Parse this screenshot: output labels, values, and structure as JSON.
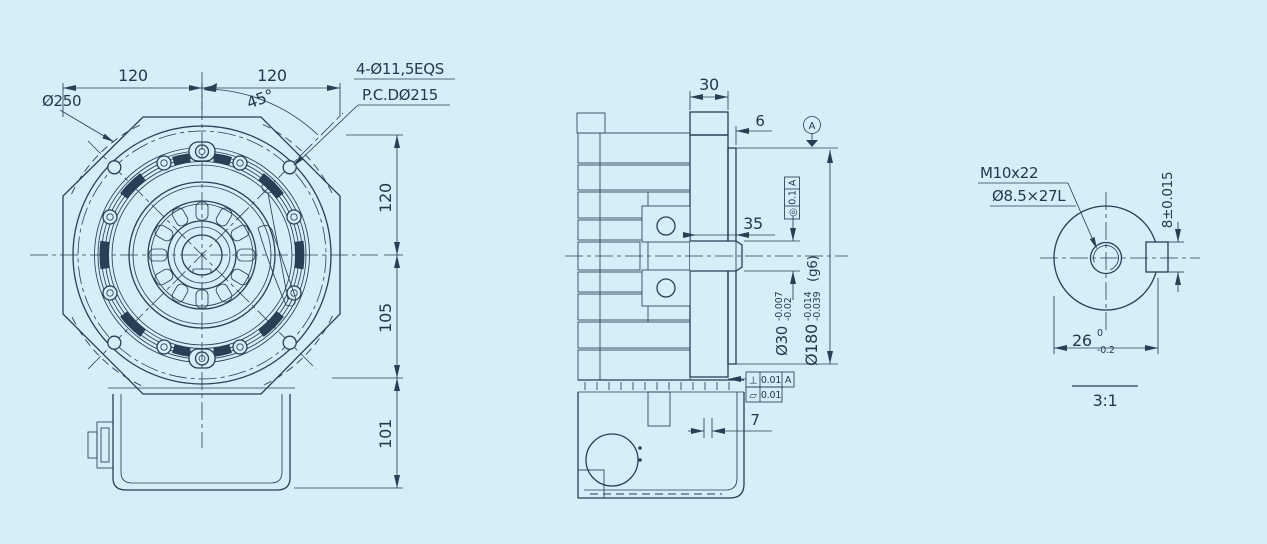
{
  "colors": {
    "background": "#d7edf8",
    "line": "#2a3f55"
  },
  "front_view": {
    "dims": {
      "top_left": "120",
      "top_right": "120",
      "angle": "45°",
      "right_top": "120",
      "right_mid": "105",
      "right_bottom": "101"
    },
    "labels": {
      "outer_dia": "Ø250",
      "holes_note": "4-Ø11,5EQS",
      "pcd_note": "P.C.DØ215"
    }
  },
  "section_view": {
    "dims": {
      "flange_width": "30",
      "spigot_step": "6",
      "shaft_len": "35",
      "rear_gap": "7"
    },
    "datum": "A",
    "fcf_runout": {
      "sym": "◎",
      "tol": "0.1",
      "ref": "A"
    },
    "fcf_perp": {
      "sym": "⊥",
      "tol": "0.01",
      "ref": "A"
    },
    "fcf_flat": {
      "sym": "▱",
      "tol": "0.01"
    },
    "shaft_dia": {
      "nom": "Ø30",
      "up": "-0.007",
      "low": "-0.02"
    },
    "spigot_dia": {
      "nom": "Ø180",
      "up": "-0.014",
      "low": "-0.039",
      "fit": "(g6)"
    }
  },
  "detail_view": {
    "thread_note": "M10x22",
    "hole_note": "Ø8.5×27L",
    "key_width": "8±0.015",
    "shaft_width": {
      "nom": "26",
      "up": "0",
      "low": "-0.2"
    },
    "scale_label": "3:1"
  }
}
